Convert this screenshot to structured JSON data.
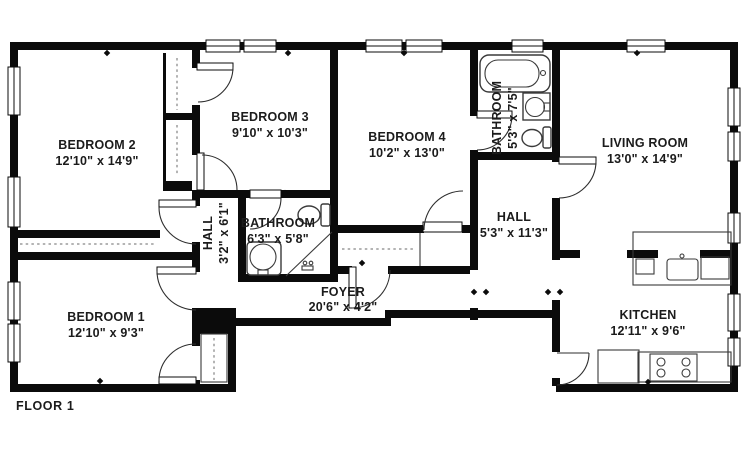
{
  "floor_plan": {
    "floor_label": "FLOOR 1",
    "colors": {
      "wall": "#0b0b0b",
      "background": "#ffffff",
      "fixture_line": "#3a3a3a",
      "text": "#1b1b1b"
    },
    "rooms": [
      {
        "id": "bedroom-2",
        "name": "BEDROOM 2",
        "dims": "12'10\" x 14'9\""
      },
      {
        "id": "bedroom-3",
        "name": "BEDROOM 3",
        "dims": "9'10\" x 10'3\""
      },
      {
        "id": "bedroom-4",
        "name": "BEDROOM 4",
        "dims": "10'2\" x 13'0\""
      },
      {
        "id": "bathroom-2",
        "name": "BATHROOM",
        "dims": "5'3\" x 7'5\""
      },
      {
        "id": "living-room",
        "name": "LIVING ROOM",
        "dims": "13'0\" x 14'9\""
      },
      {
        "id": "hall-1",
        "name": "HALL",
        "dims": "3'2\" x 6'1\""
      },
      {
        "id": "bathroom-1",
        "name": "BATHROOM",
        "dims": "6'3\" x 5'8\""
      },
      {
        "id": "hall-2",
        "name": "HALL",
        "dims": "5'3\" x 11'3\""
      },
      {
        "id": "foyer",
        "name": "FOYER",
        "dims": "20'6\" x 4'2\""
      },
      {
        "id": "bedroom-1",
        "name": "BEDROOM 1",
        "dims": "12'10\" x 9'3\""
      },
      {
        "id": "kitchen",
        "name": "KITCHEN",
        "dims": "12'11\" x 9'6\""
      }
    ],
    "fixtures": [
      "bathtub-icon",
      "toilet-icon",
      "pedestal-sink-icon",
      "vanity-sink-icon",
      "shower-icon",
      "kitchen-sink-icon",
      "stove-icon",
      "counter",
      "dishwasher-icon",
      "closet-rod"
    ]
  }
}
